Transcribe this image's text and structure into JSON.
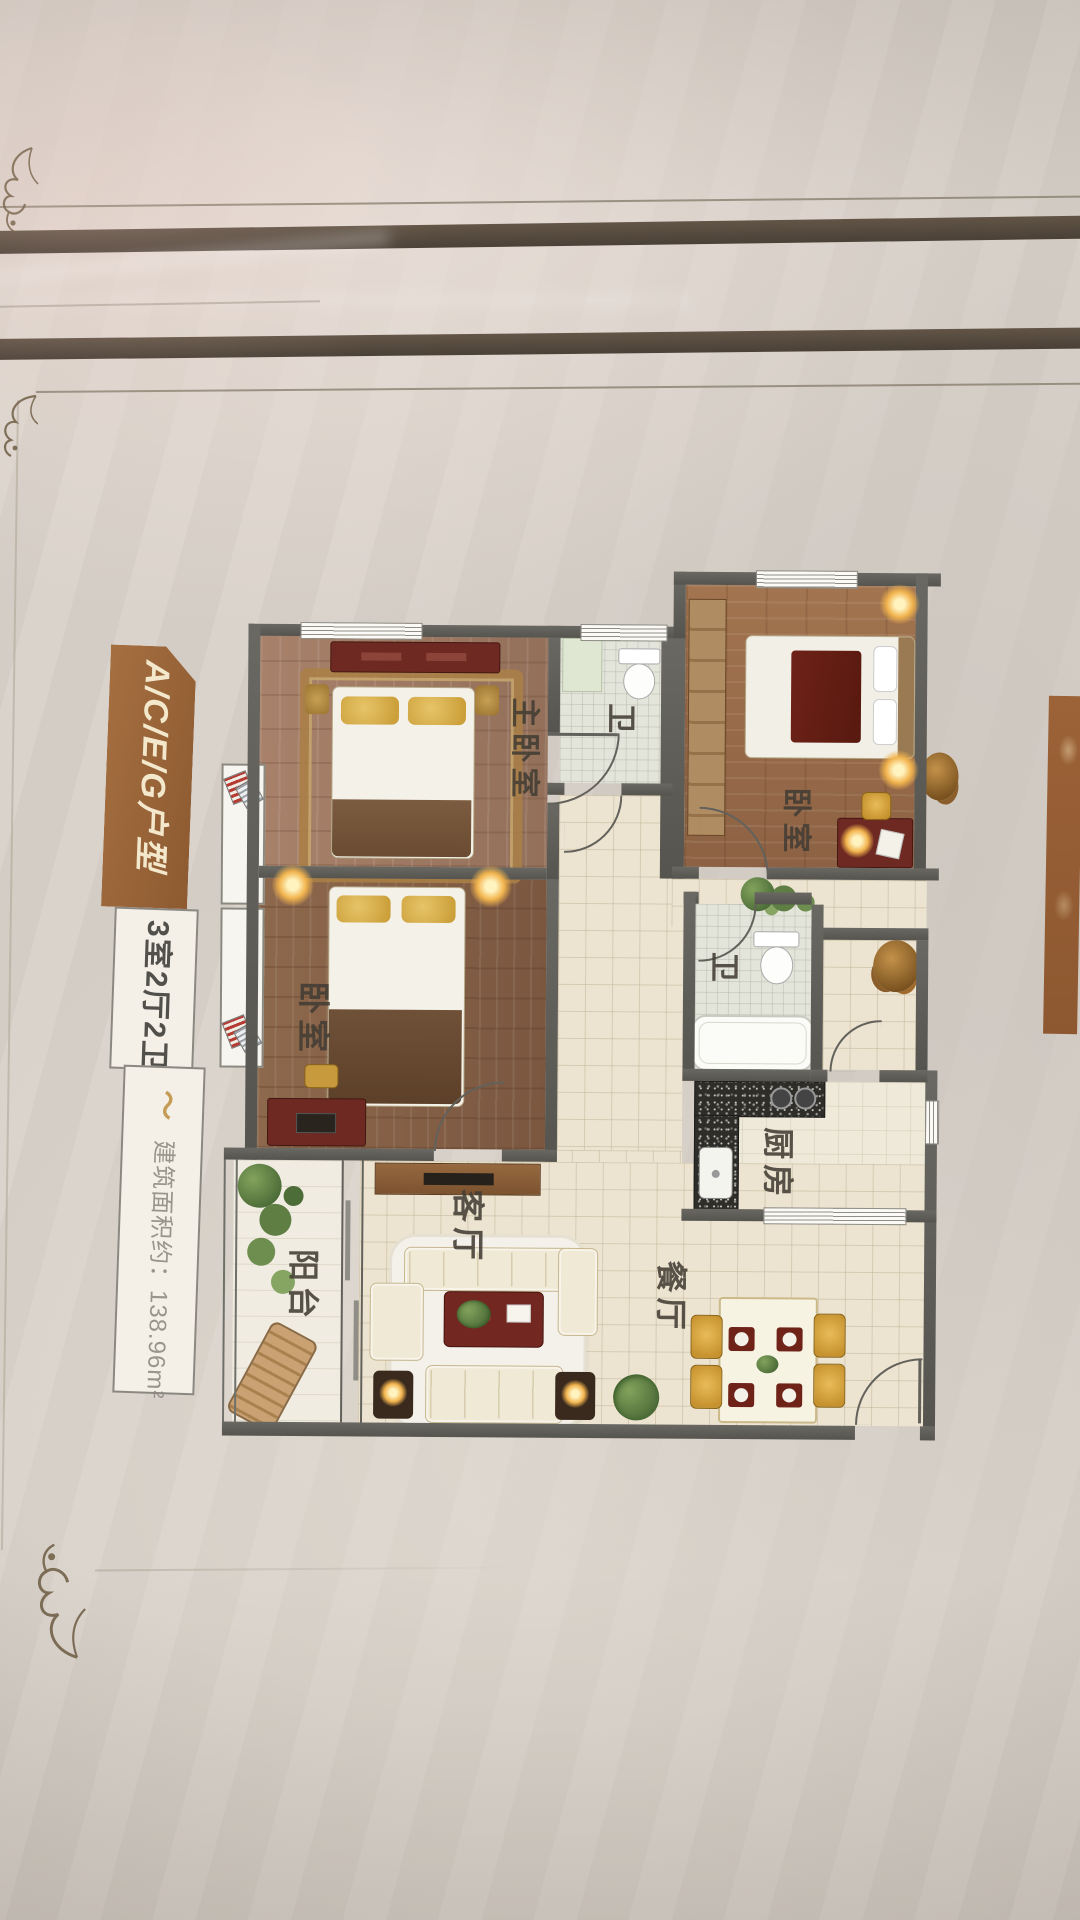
{
  "poster": {
    "unit_type": "A/C/E/G户型",
    "layout": "3室2厅2卫",
    "area": "建筑面积约：138.96m²",
    "flourish": "～"
  },
  "floorplan": {
    "rooms": [
      {
        "id": "master-bedroom",
        "label": "主卧室"
      },
      {
        "id": "bedroom-left",
        "label": "卧室"
      },
      {
        "id": "bedroom-right",
        "label": "卧室"
      },
      {
        "id": "bath-top",
        "label": "卫"
      },
      {
        "id": "bath-middle",
        "label": "卫"
      },
      {
        "id": "kitchen",
        "label": "厨房"
      },
      {
        "id": "living-room",
        "label": "客厅"
      },
      {
        "id": "dining-room",
        "label": "餐厅"
      },
      {
        "id": "balcony",
        "label": "阳台"
      }
    ]
  },
  "colors": {
    "banner_brown": "#9c6a3e",
    "wall_gray": "#5f5d58",
    "wood_floor": "#9a7355",
    "tile_floor": "#ece4d1",
    "accent_red": "#6e2a22",
    "chair_yellow": "#d9a63f",
    "lamp_glow": "#ffd98a"
  },
  "icons": {
    "corner_flourish": "filigree-corner",
    "area_flourish": "gold-swoosh",
    "ac_unit": "air-conditioner"
  }
}
